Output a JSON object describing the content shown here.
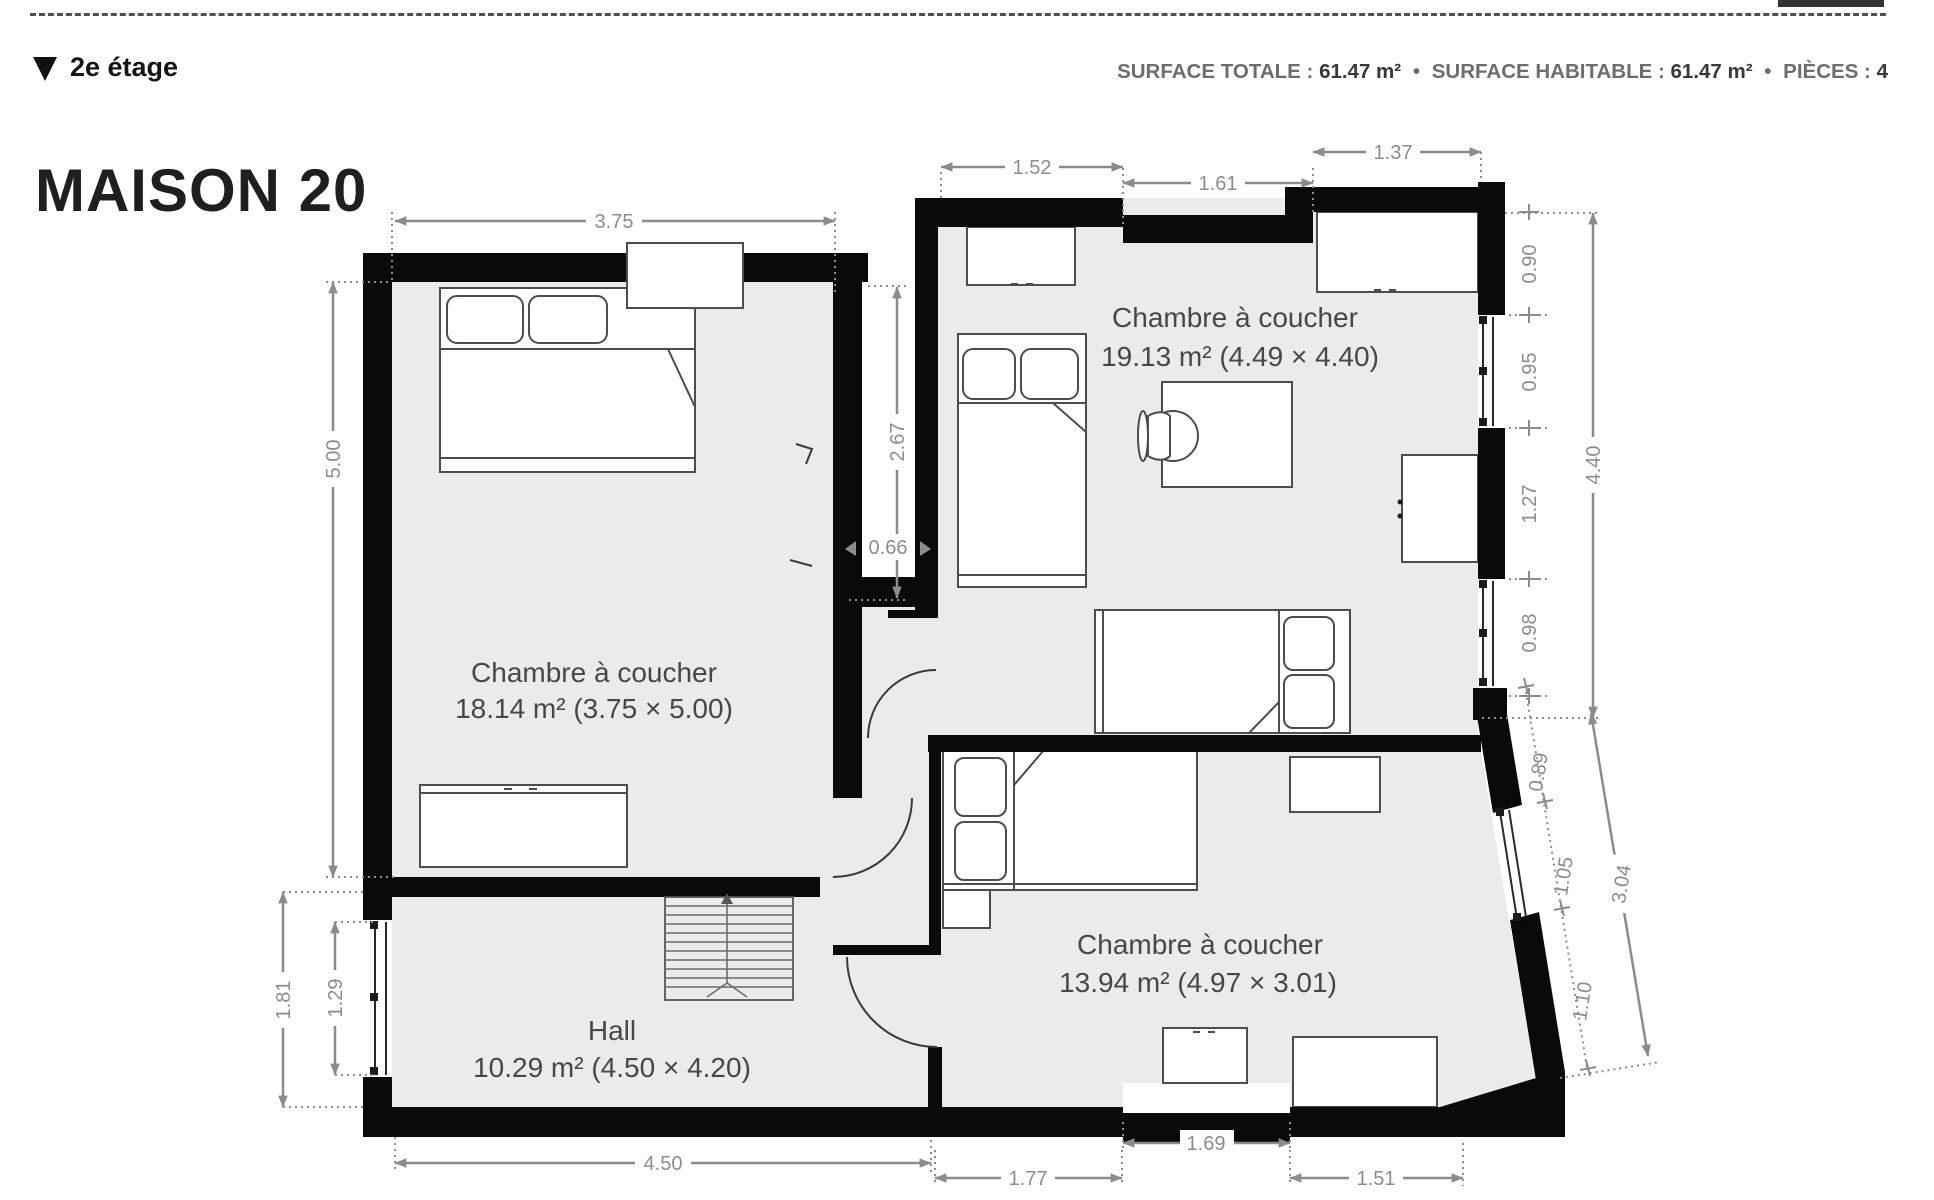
{
  "page": {
    "floor_label": "2e étage",
    "title": "MAISON 20"
  },
  "stats": {
    "surface_totale_label": "SURFACE TOTALE :",
    "surface_totale_value": "61.47 m²",
    "sep1": "•",
    "surface_habitable_label": "SURFACE HABITABLE :",
    "surface_habitable_value": "61.47 m²",
    "sep2": "•",
    "pieces_label": "PIÈCES :",
    "pieces_value": "4"
  },
  "rooms": {
    "bedroom_left": {
      "name": "Chambre à coucher",
      "area": "18.14 m² (3.75 × 5.00)"
    },
    "bedroom_top_right": {
      "name": "Chambre à coucher",
      "area": "19.13 m² (4.49 × 4.40)"
    },
    "bedroom_bottom_right": {
      "name": "Chambre à coucher",
      "area": "13.94 m² (4.97 × 3.01)"
    },
    "hall": {
      "name": "Hall",
      "area": "10.29 m² (4.50 × 4.20)"
    }
  },
  "dimensions": {
    "left_room_width": "3.75",
    "left_room_height": "5.00",
    "corridor_height": "2.67",
    "passage_width": "0.66",
    "top_seg_1": "1.52",
    "top_seg_2": "1.61",
    "top_seg_3": "1.37",
    "right_seg_1": "0.90",
    "right_seg_2": "0.95",
    "right_seg_3": "1.27",
    "right_seg_4": "0.98",
    "right_total": "4.40",
    "slant_seg_1": "0.89",
    "slant_seg_2": "1.05",
    "slant_seg_3": "1.10",
    "slant_total": "3.04",
    "bottom_hall": "4.50",
    "bottom_seg_1": "1.77",
    "bottom_seg_2": "1.69",
    "bottom_seg_3": "1.51",
    "left_bottom_total": "1.81",
    "left_bottom_window": "1.29"
  },
  "colors": {
    "wall": "#0a0a0a",
    "floor": "#ebebeb",
    "dimension": "#8c8c8c",
    "label": "#474747"
  }
}
